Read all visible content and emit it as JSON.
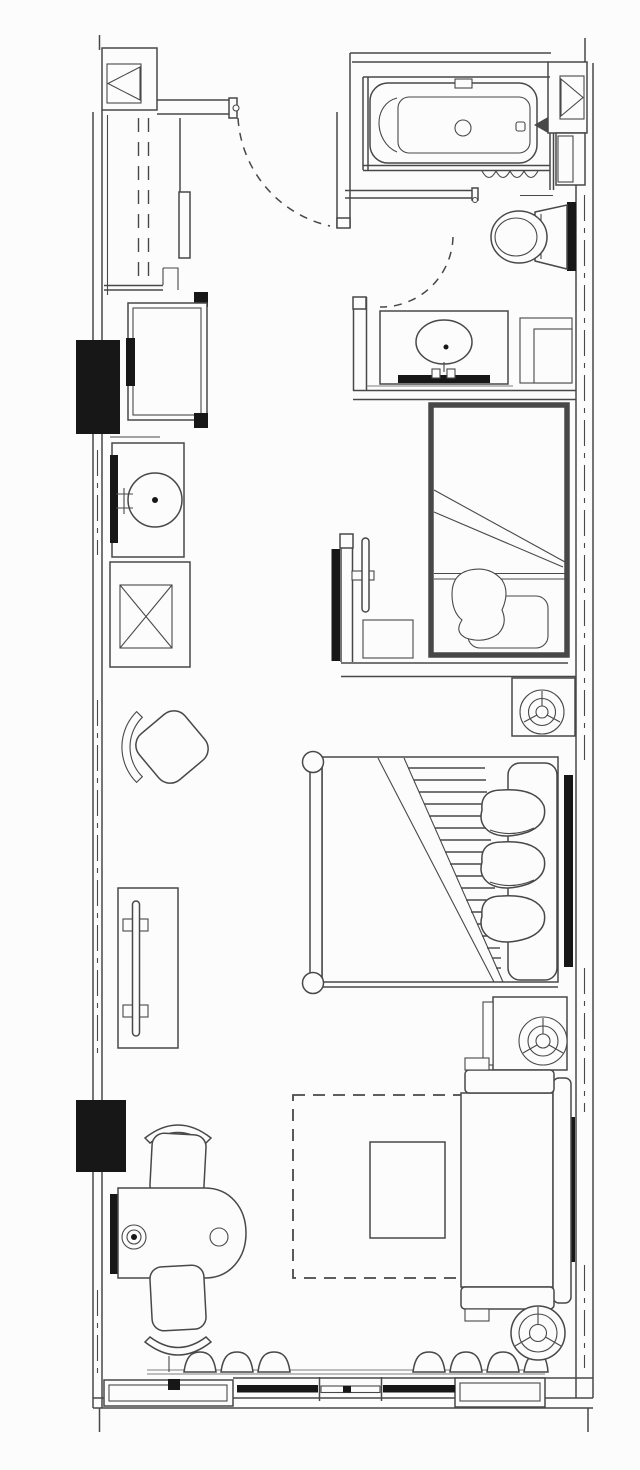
{
  "canvas": {
    "viewBox": "0 0 640 1470",
    "width_px": 640,
    "height_px": 1470
  },
  "colors": {
    "paper": "#fcfcfc",
    "ink": "#484848",
    "ink_light": "#979797",
    "black": "#171717"
  },
  "drawing": {
    "kind": "hotel guestroom floor plan",
    "style": "black-and-white scanned architectural line drawing, no text labels",
    "visible_text": []
  },
  "plan": {
    "zones": [
      "entry-hall",
      "wardrobe-closet",
      "bathroom",
      "vanity-corridor",
      "sleeping-area",
      "lounge-area",
      "window-wall"
    ],
    "symbols": [
      "shaft-column-left",
      "shaft-column-right",
      "entry-door-swing",
      "bathroom-door-swing",
      "wardrobe-hanging-rod",
      "minibar-cabinet",
      "wet-bar-sink",
      "service-shaft-x",
      "rotated-lounge-chair",
      "bathtub",
      "tub-faucet",
      "towel-squiggle",
      "toilet",
      "vanity-counter-basin",
      "shelf-niche",
      "daybed-nook",
      "nook-tv",
      "nook-stool",
      "king-bed",
      "footboard-posts",
      "folded-duvet-hatch",
      "bed-pillows",
      "headboard",
      "nightstand-lamp-upper",
      "nightstand-lamp-lower",
      "tv-console",
      "wall-tv",
      "writing-desk",
      "desk-lamp",
      "dining-chair-top",
      "dining-chair-bottom",
      "area-rug-dashed",
      "coffee-table",
      "sofa",
      "floor-lamp",
      "curtains",
      "window-band",
      "wall-blackout-panels"
    ]
  }
}
